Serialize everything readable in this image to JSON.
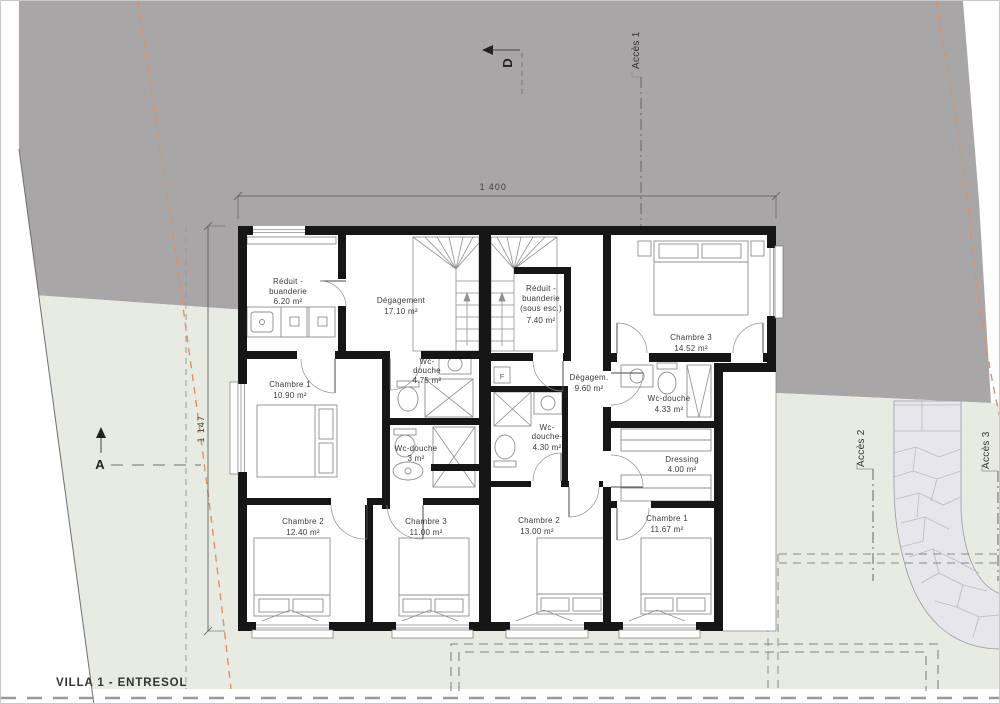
{
  "title": "VILLA 1 - ENTRESOL",
  "dimensions": {
    "overall_width": "1 400",
    "overall_height": "1 147"
  },
  "markers": {
    "section_a": "A",
    "section_d": "D"
  },
  "access": {
    "a1": "Accès 1",
    "a2": "Accès 2",
    "a3": "Accès 3"
  },
  "fixtures": {
    "f_box": "F"
  },
  "rooms": {
    "a_reduit": {
      "l1": "Réduit -",
      "l2": "buanderie",
      "area": "6.20 m²"
    },
    "a_degagement": {
      "l1": "Dégagement",
      "area": "17.10 m²"
    },
    "a_ch1": {
      "l1": "Chambre 1",
      "area": "10.90 m²"
    },
    "a_wc1": {
      "l1": "Wc-",
      "l2": "douche",
      "area": "4.75 m²"
    },
    "a_wc2": {
      "l1": "Wc-douche",
      "area": "3 m²"
    },
    "a_ch2": {
      "l1": "Chambre 2",
      "area": "12.40 m²"
    },
    "a_ch3": {
      "l1": "Chambre 3",
      "area": "11.00 m²"
    },
    "b_reduit": {
      "l1": "Réduit -",
      "l2": "buanderie",
      "l3": "(sous esc.)",
      "area": "7.40 m²"
    },
    "b_ch3": {
      "l1": "Chambre 3",
      "area": "14.52 m²"
    },
    "b_degagement": {
      "l1": "Dégagem.",
      "area": "9.60 m²"
    },
    "b_wc1": {
      "l1": "Wc-douche",
      "area": "4.33 m²"
    },
    "b_wc2": {
      "l1": "Wc-",
      "l2": "douche-",
      "area": "4.30 m²"
    },
    "b_dressing": {
      "l1": "Dressing",
      "area": "4.00 m²"
    },
    "b_ch2": {
      "l1": "Chambre 2",
      "area": "13.00 m²"
    },
    "b_ch1": {
      "l1": "Chambre 1",
      "area": "11.67 m²"
    }
  },
  "colors": {
    "terrain_upper_gray": "#a8a6a7",
    "terrain_lower_green": "#e7ebe1",
    "stone_path": "#e6e6eb",
    "boundary_orange": "#dd9166",
    "wall_black": "#161616"
  }
}
